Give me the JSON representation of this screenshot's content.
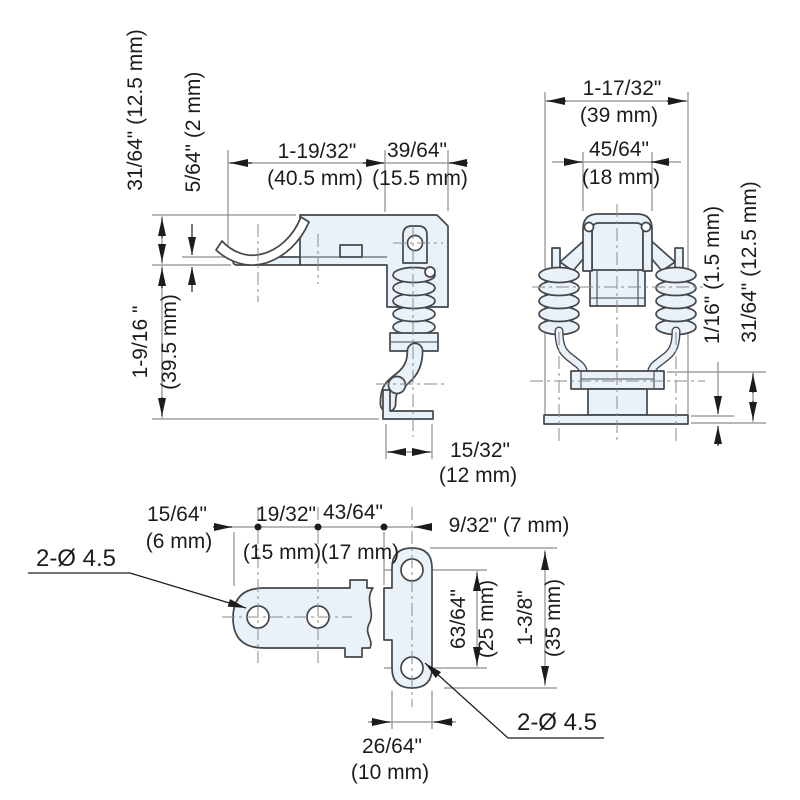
{
  "colors": {
    "part_fill": "#e9f1f9",
    "outline": "#43474b",
    "dim_line": "#8a8c8e",
    "text": "#1c1c1c"
  },
  "side_view": {
    "width_top": "1-19/32\"",
    "width_top_mm": "(40.5 mm)",
    "width_right": "39/64\"",
    "width_right_mm": "(15.5 mm)",
    "lip_height": "31/64\" (12.5 mm)",
    "lip_gap": "5/64\" (2 mm)",
    "body_height": "1-9/16 \"",
    "body_height_mm": "(39.5 mm)",
    "foot_width": "15/32\"",
    "foot_width_mm": "(12 mm)"
  },
  "front_view": {
    "width_outer": "1-17/32\"",
    "width_outer_mm": "(39 mm)",
    "width_inner": "45/64\"",
    "width_inner_mm": "(18 mm)",
    "base_thickness": "1/16\" (1.5 mm)",
    "base_height": "31/64\" (12.5 mm)"
  },
  "bottom_view": {
    "edge_to_hole": "15/64\"",
    "edge_to_hole_mm": "(6 mm)",
    "hole_spacing": "19/32\"",
    "hole_spacing_mm": "(15 mm)",
    "hole_to_plate": "43/64\"",
    "hole_to_plate_mm": "(17 mm)",
    "plate_offset": "9/32\" (7 mm)",
    "holes_left_label": "2-Ø 4.5",
    "holes_right_label": "2-Ø 4.5",
    "hole_spacing_vertical": "63/64\"",
    "hole_spacing_vertical_mm": "(25 mm)",
    "plate_height": "1-3/8\"",
    "plate_height_mm": "(35 mm)",
    "plate_width": "26/64\"",
    "plate_width_mm": "(10 mm)"
  }
}
